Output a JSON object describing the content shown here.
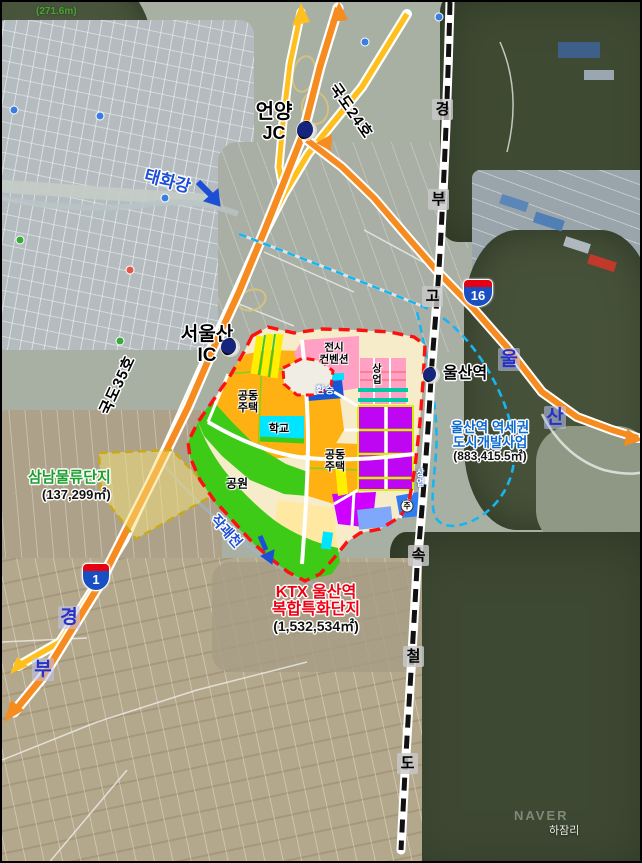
{
  "frame": {
    "elevation": "(271.6m)",
    "watermark": "NAVER",
    "village": "하잠리"
  },
  "markers": {
    "eonyang_jc": {
      "line1": "언양",
      "line2": "JC"
    },
    "seoulsan_ic": {
      "line1": "서울산",
      "line2": "IC"
    },
    "ulsan_station": {
      "label": "울산역"
    }
  },
  "roads": {
    "national_24": "국도24호",
    "national_35": "국도35호",
    "shield_16": "16",
    "shield_1": "1",
    "ulsan_expwy_chars": [
      "울",
      "산"
    ],
    "gyeongbu_expwy_chars": [
      "경",
      "부"
    ]
  },
  "railway": {
    "name_chars": [
      "경",
      "부",
      "고",
      "속",
      "철",
      "도"
    ]
  },
  "waterways": {
    "taehwa": "태화강",
    "jakgwae": "작괘천"
  },
  "projects": {
    "ktx_complex": {
      "name_line1": "KTX 울산역",
      "name_line2": "복합특화단지",
      "area": "(1,532,534㎡)"
    },
    "station_district": {
      "name_line1": "울산역 역세권",
      "name_line2": "도시개발사업",
      "area": "(883,415.5㎡)"
    },
    "samnam_logistics": {
      "name": "삼남물류단지",
      "area": "(137,299㎡)"
    }
  },
  "land_use": {
    "apartment_nw": "공동\n주택",
    "apartment_c": "공동\n주택",
    "school": "학교",
    "park": "공원",
    "exhibition": "전시\n컨벤션",
    "commercial_east": "상업",
    "commercial_south": "상업",
    "transfer": "환승",
    "parking": "주"
  },
  "colors": {
    "expressway": "#f68b1f",
    "national_road": "#ffc01e",
    "site_boundary": "#ff1010",
    "district_boundary": "#19b5f1",
    "logistics_boundary": "#c9a918",
    "apartment": "#ffb012",
    "park": "#3ecb17",
    "commercial": "#bf06f2",
    "exhibition": "#ffa0c4",
    "school": "#00e5ff"
  }
}
